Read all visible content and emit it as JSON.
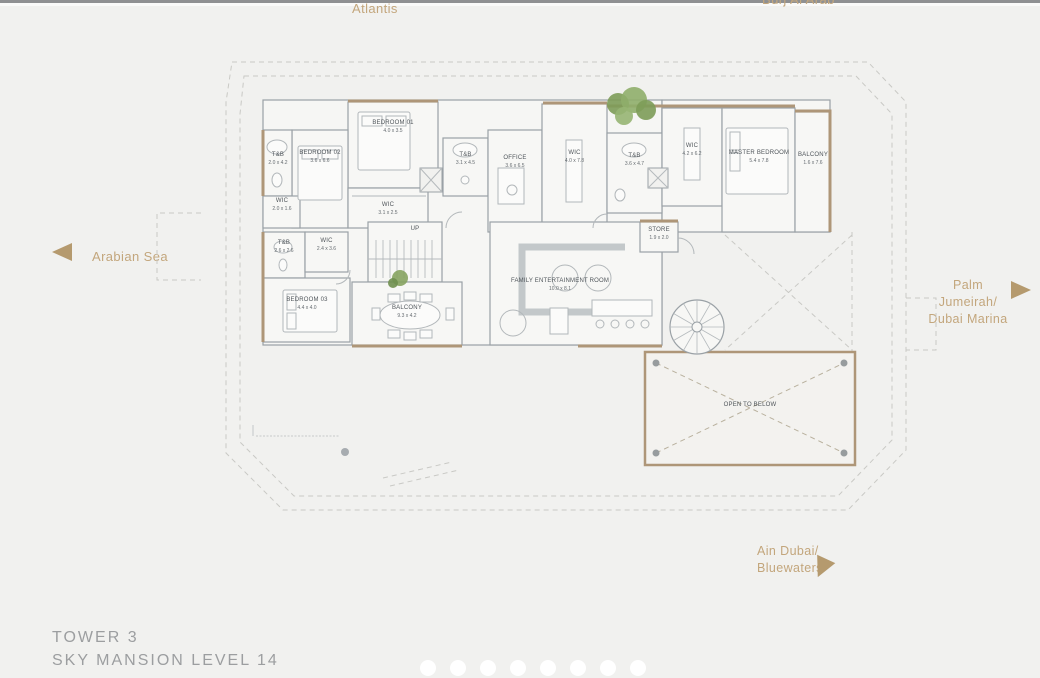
{
  "page": {
    "title_line1": "TOWER 3",
    "title_line2": "SKY MANSION LEVEL 14"
  },
  "landmarks": {
    "top": "Atlantis",
    "top_right": "Burj Al Arab",
    "left": "Arabian Sea",
    "right_line1": "Palm Jumeirah/",
    "right_line2": "Dubai Marina",
    "bottom_line1": "Ain Dubai/",
    "bottom_line2": "Bluewaters"
  },
  "rooms": [
    {
      "name": "BEDROOM 01",
      "dims": "4.0 x 3.5"
    },
    {
      "name": "BEDROOM 02",
      "dims": "3.6 x 6.6"
    },
    {
      "name": "T&B",
      "dims": "2.0 x 4.2"
    },
    {
      "name": "WIC",
      "dims": "3.1 x 2.5"
    },
    {
      "name": "WIC",
      "dims": "2.0 x 1.6"
    },
    {
      "name": "T&B",
      "dims": "2.6 x 2.6"
    },
    {
      "name": "WIC",
      "dims": "2.4 x 3.6"
    },
    {
      "name": "BEDROOM 03",
      "dims": "4.4 x 4.0"
    },
    {
      "name": "T&B",
      "dims": "3.1 x 4.5"
    },
    {
      "name": "OFFICE",
      "dims": "3.6 x 6.5"
    },
    {
      "name": "WIC",
      "dims": "4.0 x 7.8"
    },
    {
      "name": "T&B",
      "dims": "3.6 x 4.7"
    },
    {
      "name": "WIC",
      "dims": "4.2 x 6.2"
    },
    {
      "name": "MASTER BEDROOM",
      "dims": "5.4 x 7.8"
    },
    {
      "name": "BALCONY",
      "dims": "1.6 x 7.6"
    },
    {
      "name": "UP",
      "dims": ""
    },
    {
      "name": "BALCONY",
      "dims": "9.3 x 4.2"
    },
    {
      "name": "FAMILY ENTERTAINMENT ROOM",
      "dims": "10.0 x 8.1"
    },
    {
      "name": "STORE",
      "dims": "1.9 x 2.0"
    },
    {
      "name": "OPEN TO BELOW",
      "dims": ""
    }
  ],
  "pagination": {
    "dot_count": 8
  },
  "colors": {
    "background": "#f1f1ef",
    "landmark_text": "#c3a67c",
    "arrow_accent": "#b59a6e",
    "wall_tan": "#ae9678",
    "wall_gray": "#9aa1a6",
    "room_fill": "#f7f7f5",
    "label_text": "#4f555a",
    "title_text": "#9c9ea0",
    "tree_green": "#7d9c58"
  }
}
